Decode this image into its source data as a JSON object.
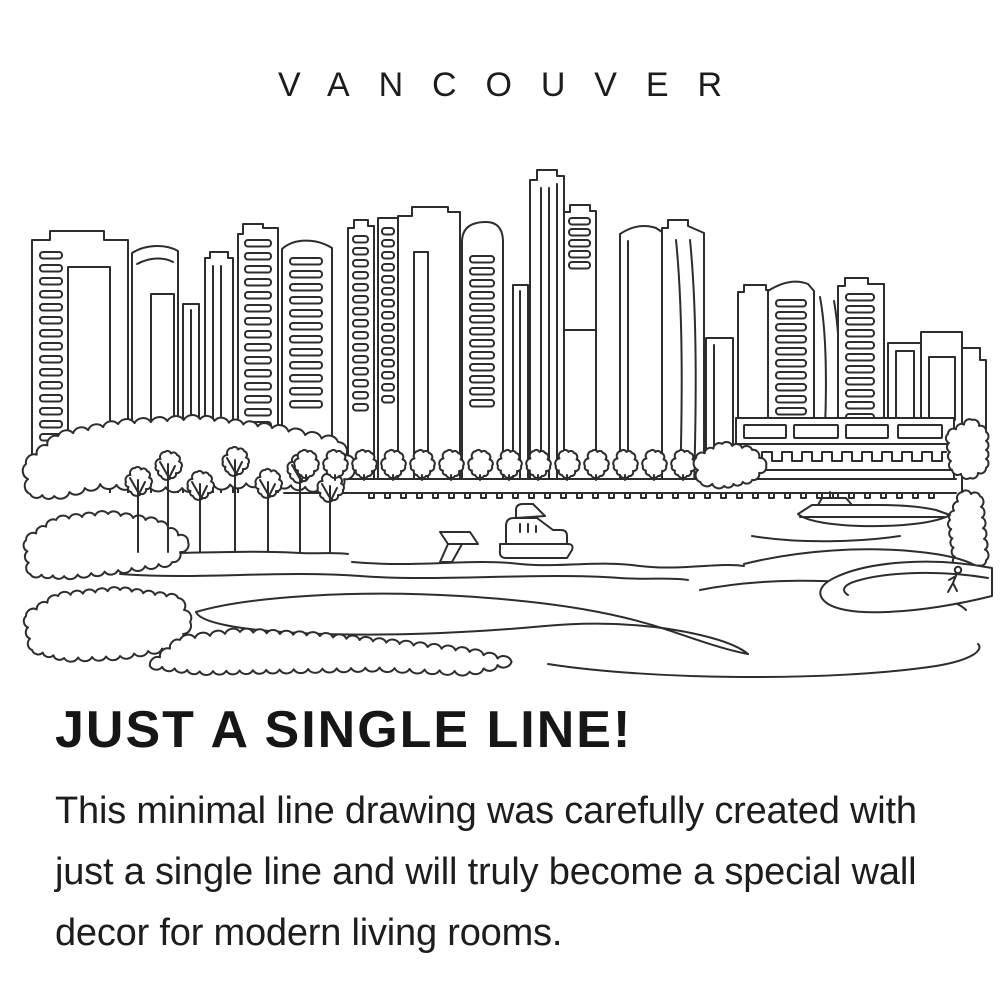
{
  "title": "VANCOUVER",
  "heading": "JUST A SINGLE LINE!",
  "description": "This minimal line drawing was carefully created with just a single line and will truly become a special wall decor for modern living rooms.",
  "artwork": {
    "alt": "Vancouver skyline single line drawing",
    "stroke_color": "#2d2d2d",
    "background_color": "#ffffff",
    "text_color": "#1a1a1a"
  }
}
